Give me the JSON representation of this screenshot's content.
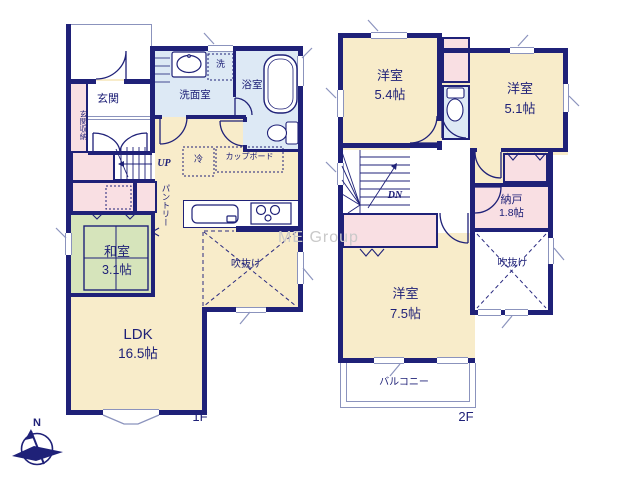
{
  "watermark": "ME Group",
  "compass": {
    "north": "N"
  },
  "colors": {
    "wall_navy": "#1f2178",
    "floor_beige": "#f8ecca",
    "closet_pink": "#f9dfe3",
    "wet_area_blue": "#dde9f5",
    "tatami_green": "#d6e4bb",
    "window_gray": "#8b93bd",
    "watermark_gray": "#c9c9c9"
  },
  "f1": {
    "label": "1F",
    "genkan": "玄関",
    "genkan_storage": "玄関収納",
    "senmen": "洗面室",
    "washer": "洗",
    "bath": "浴室",
    "fridge": "冷",
    "cupboard": "カップボード",
    "pantry": "パントリー",
    "up": "UP",
    "washitsu": "和室",
    "washitsu_size": "3.1帖",
    "fukinuke": "吹抜け",
    "ldk": "LDK",
    "ldk_size": "16.5帖"
  },
  "f2": {
    "label": "2F",
    "bed1": "洋室",
    "bed1_size": "5.4帖",
    "bed2": "洋室",
    "bed2_size": "5.1帖",
    "bed3": "洋室",
    "bed3_size": "7.5帖",
    "nando": "納戸",
    "nando_size": "1.8帖",
    "fukinuke": "吹抜け",
    "balcony": "バルコニー",
    "dn": "DN"
  }
}
